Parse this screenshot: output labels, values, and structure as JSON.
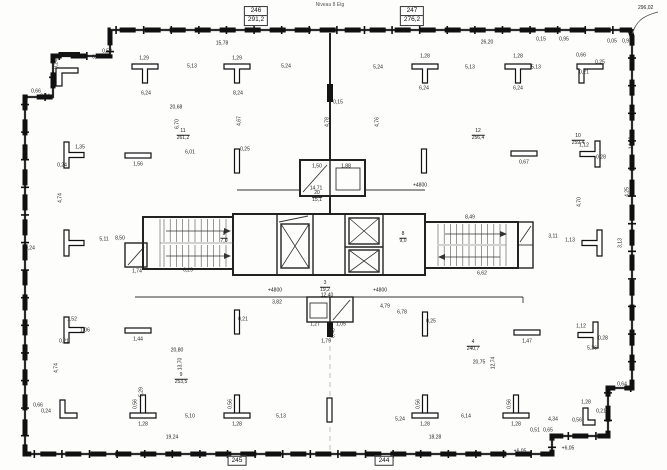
{
  "meta": {
    "title_note": "Niveau 8 Etg",
    "corner_dim": "296,02"
  },
  "room_tags": [
    {
      "no": "246",
      "area": "291,2",
      "x": 256,
      "y": 16
    },
    {
      "no": "247",
      "area": "276,2",
      "x": 412,
      "y": 16
    },
    {
      "no": "245",
      "area": "",
      "x": 237,
      "y": 461
    },
    {
      "no": "244",
      "area": "",
      "x": 384,
      "y": 461
    }
  ],
  "area_fractions": [
    {
      "n": "11",
      "d": "261,2",
      "x": 183,
      "y": 135
    },
    {
      "n": "12",
      "d": "256,4",
      "x": 478,
      "y": 135
    },
    {
      "n": "10",
      "d": "259,4",
      "x": 578,
      "y": 140
    },
    {
      "n": "9",
      "d": "253,5",
      "x": 181,
      "y": 379
    },
    {
      "n": "4",
      "d": "240,7",
      "x": 473,
      "y": 346
    },
    {
      "n": "8",
      "d": "7,0",
      "x": 224,
      "y": 238
    },
    {
      "n": "8",
      "d": "9,0",
      "x": 403,
      "y": 238
    },
    {
      "n": "3",
      "d": "19,2",
      "x": 325,
      "y": 287
    },
    {
      "n": "20",
      "d": "15,1",
      "x": 317,
      "y": 197
    }
  ],
  "dimension_labels": [
    {
      "t": "15,78",
      "x": 222,
      "y": 44
    },
    {
      "t": "26,20",
      "x": 487,
      "y": 43
    },
    {
      "t": "0,15",
      "x": 541,
      "y": 40
    },
    {
      "t": "0,95",
      "x": 564,
      "y": 40
    },
    {
      "t": "0,05",
      "x": 612,
      "y": 42
    },
    {
      "t": "0,91",
      "x": 627,
      "y": 42
    },
    {
      "t": "5,13",
      "x": 192,
      "y": 67
    },
    {
      "t": "5,24",
      "x": 286,
      "y": 67
    },
    {
      "t": "5,24",
      "x": 378,
      "y": 68
    },
    {
      "t": "5,13",
      "x": 470,
      "y": 68
    },
    {
      "t": "5,13",
      "x": 536,
      "y": 68
    },
    {
      "t": "1,29",
      "x": 144,
      "y": 59
    },
    {
      "t": "1,29",
      "x": 237,
      "y": 59
    },
    {
      "t": "1,28",
      "x": 425,
      "y": 57
    },
    {
      "t": "1,28",
      "x": 518,
      "y": 57
    },
    {
      "t": "6,24",
      "x": 146,
      "y": 94
    },
    {
      "t": "8,24",
      "x": 238,
      "y": 94
    },
    {
      "t": "6,24",
      "x": 424,
      "y": 89
    },
    {
      "t": "6,24",
      "x": 518,
      "y": 89
    },
    {
      "t": "0,66",
      "x": 581,
      "y": 56
    },
    {
      "t": "0,25",
      "x": 600,
      "y": 63
    },
    {
      "t": "0,21",
      "x": 584,
      "y": 73
    },
    {
      "t": "6,85",
      "x": 70,
      "y": 56
    },
    {
      "t": "0,87",
      "x": 97,
      "y": 58
    },
    {
      "t": "0,53",
      "x": 107,
      "y": 52
    },
    {
      "t": "0,24",
      "x": 57,
      "y": 64,
      "r": 90
    },
    {
      "t": "4,74",
      "x": 61,
      "y": 198,
      "r": 90
    },
    {
      "t": "4,70",
      "x": 580,
      "y": 202,
      "r": 90
    },
    {
      "t": "4,25",
      "x": 628,
      "y": 192,
      "r": 90
    },
    {
      "t": "14,28",
      "x": 632,
      "y": 143,
      "r": 90
    },
    {
      "t": "20,68",
      "x": 176,
      "y": 108
    },
    {
      "t": "6,70",
      "x": 178,
      "y": 124,
      "r": 90
    },
    {
      "t": "6,01",
      "x": 190,
      "y": 153
    },
    {
      "t": "4,67",
      "x": 240,
      "y": 121,
      "r": 90
    },
    {
      "t": "4,76",
      "x": 378,
      "y": 122,
      "r": 90
    },
    {
      "t": "0,24",
      "x": 30,
      "y": 249
    },
    {
      "t": "5,11",
      "x": 104,
      "y": 240
    },
    {
      "t": "8,50",
      "x": 120,
      "y": 239
    },
    {
      "t": "3,11",
      "x": 553,
      "y": 237
    },
    {
      "t": "1,13",
      "x": 570,
      "y": 241
    },
    {
      "t": "3,13",
      "x": 621,
      "y": 243,
      "r": 90
    },
    {
      "t": "1,35",
      "x": 80,
      "y": 148
    },
    {
      "t": "0,24",
      "x": 62,
      "y": 166
    },
    {
      "t": "1,56",
      "x": 138,
      "y": 165
    },
    {
      "t": "0,25",
      "x": 245,
      "y": 150
    },
    {
      "t": "0,67",
      "x": 524,
      "y": 163
    },
    {
      "t": "1,12",
      "x": 584,
      "y": 146
    },
    {
      "t": "0,28",
      "x": 601,
      "y": 158
    },
    {
      "t": "0,15",
      "x": 338,
      "y": 103
    },
    {
      "t": "4,78",
      "x": 328,
      "y": 122,
      "r": 90
    },
    {
      "t": "1,50",
      "x": 317,
      "y": 167
    },
    {
      "t": "1,88",
      "x": 346,
      "y": 167
    },
    {
      "t": "14,71",
      "x": 316,
      "y": 189
    },
    {
      "t": "1,74",
      "x": 137,
      "y": 272
    },
    {
      "t": "6,29",
      "x": 188,
      "y": 271
    },
    {
      "t": "8,49",
      "x": 470,
      "y": 218
    },
    {
      "t": "6,62",
      "x": 482,
      "y": 274
    },
    {
      "t": "+4800",
      "x": 275,
      "y": 291
    },
    {
      "t": "+4800",
      "x": 380,
      "y": 291
    },
    {
      "t": "+4800",
      "x": 420,
      "y": 186
    },
    {
      "t": "3,82",
      "x": 277,
      "y": 303
    },
    {
      "t": "4,79",
      "x": 385,
      "y": 307
    },
    {
      "t": "6,78",
      "x": 402,
      "y": 313
    },
    {
      "t": "12,40",
      "x": 327,
      "y": 296
    },
    {
      "t": "1,27",
      "x": 315,
      "y": 325
    },
    {
      "t": "1,05",
      "x": 341,
      "y": 325
    },
    {
      "t": "0,48",
      "x": 334,
      "y": 333,
      "r": 90
    },
    {
      "t": "1,79",
      "x": 326,
      "y": 342
    },
    {
      "t": "1,52",
      "x": 72,
      "y": 320
    },
    {
      "t": "1,06",
      "x": 85,
      "y": 331
    },
    {
      "t": "0,21",
      "x": 64,
      "y": 342
    },
    {
      "t": "1,44",
      "x": 138,
      "y": 340
    },
    {
      "t": "0,21",
      "x": 243,
      "y": 320
    },
    {
      "t": "0,25",
      "x": 431,
      "y": 322
    },
    {
      "t": "1,47",
      "x": 527,
      "y": 342
    },
    {
      "t": "1,12",
      "x": 581,
      "y": 327
    },
    {
      "t": "0,28",
      "x": 603,
      "y": 339
    },
    {
      "t": "5,26",
      "x": 592,
      "y": 349
    },
    {
      "t": "20,80",
      "x": 177,
      "y": 351
    },
    {
      "t": "13,70",
      "x": 181,
      "y": 364,
      "r": 90
    },
    {
      "t": "4,74",
      "x": 57,
      "y": 368,
      "r": 90
    },
    {
      "t": "20,75",
      "x": 479,
      "y": 363
    },
    {
      "t": "12,74",
      "x": 494,
      "y": 363,
      "r": 90
    },
    {
      "t": "5,29",
      "x": 142,
      "y": 392,
      "r": 90
    },
    {
      "t": "0,56",
      "x": 136,
      "y": 404,
      "r": 90
    },
    {
      "t": "0,56",
      "x": 231,
      "y": 404,
      "r": 90
    },
    {
      "t": "0,56",
      "x": 419,
      "y": 404,
      "r": 90
    },
    {
      "t": "0,56",
      "x": 510,
      "y": 404,
      "r": 90
    },
    {
      "t": "1,28",
      "x": 143,
      "y": 425
    },
    {
      "t": "1,28",
      "x": 237,
      "y": 425
    },
    {
      "t": "1,28",
      "x": 425,
      "y": 425
    },
    {
      "t": "1,28",
      "x": 516,
      "y": 425
    },
    {
      "t": "5,10",
      "x": 190,
      "y": 417
    },
    {
      "t": "5,13",
      "x": 281,
      "y": 417
    },
    {
      "t": "5,24",
      "x": 400,
      "y": 420
    },
    {
      "t": "6,14",
      "x": 466,
      "y": 417
    },
    {
      "t": "4,34",
      "x": 553,
      "y": 420
    },
    {
      "t": "19,24",
      "x": 172,
      "y": 438
    },
    {
      "t": "18,28",
      "x": 435,
      "y": 438
    },
    {
      "t": "0,64",
      "x": 622,
      "y": 385
    },
    {
      "t": "1,28",
      "x": 586,
      "y": 403
    },
    {
      "t": "0,21",
      "x": 601,
      "y": 412
    },
    {
      "t": "0,56",
      "x": 577,
      "y": 421
    },
    {
      "t": "0,51",
      "x": 535,
      "y": 431
    },
    {
      "t": "0,65",
      "x": 548,
      "y": 431
    },
    {
      "t": "+6,05",
      "x": 520,
      "y": 452
    },
    {
      "t": "+6,05",
      "x": 568,
      "y": 449
    },
    {
      "t": "0,66",
      "x": 38,
      "y": 406
    },
    {
      "t": "0,24",
      "x": 46,
      "y": 412
    },
    {
      "t": "0,66",
      "x": 36,
      "y": 92
    },
    {
      "t": "0,24",
      "x": 45,
      "y": 97
    }
  ]
}
